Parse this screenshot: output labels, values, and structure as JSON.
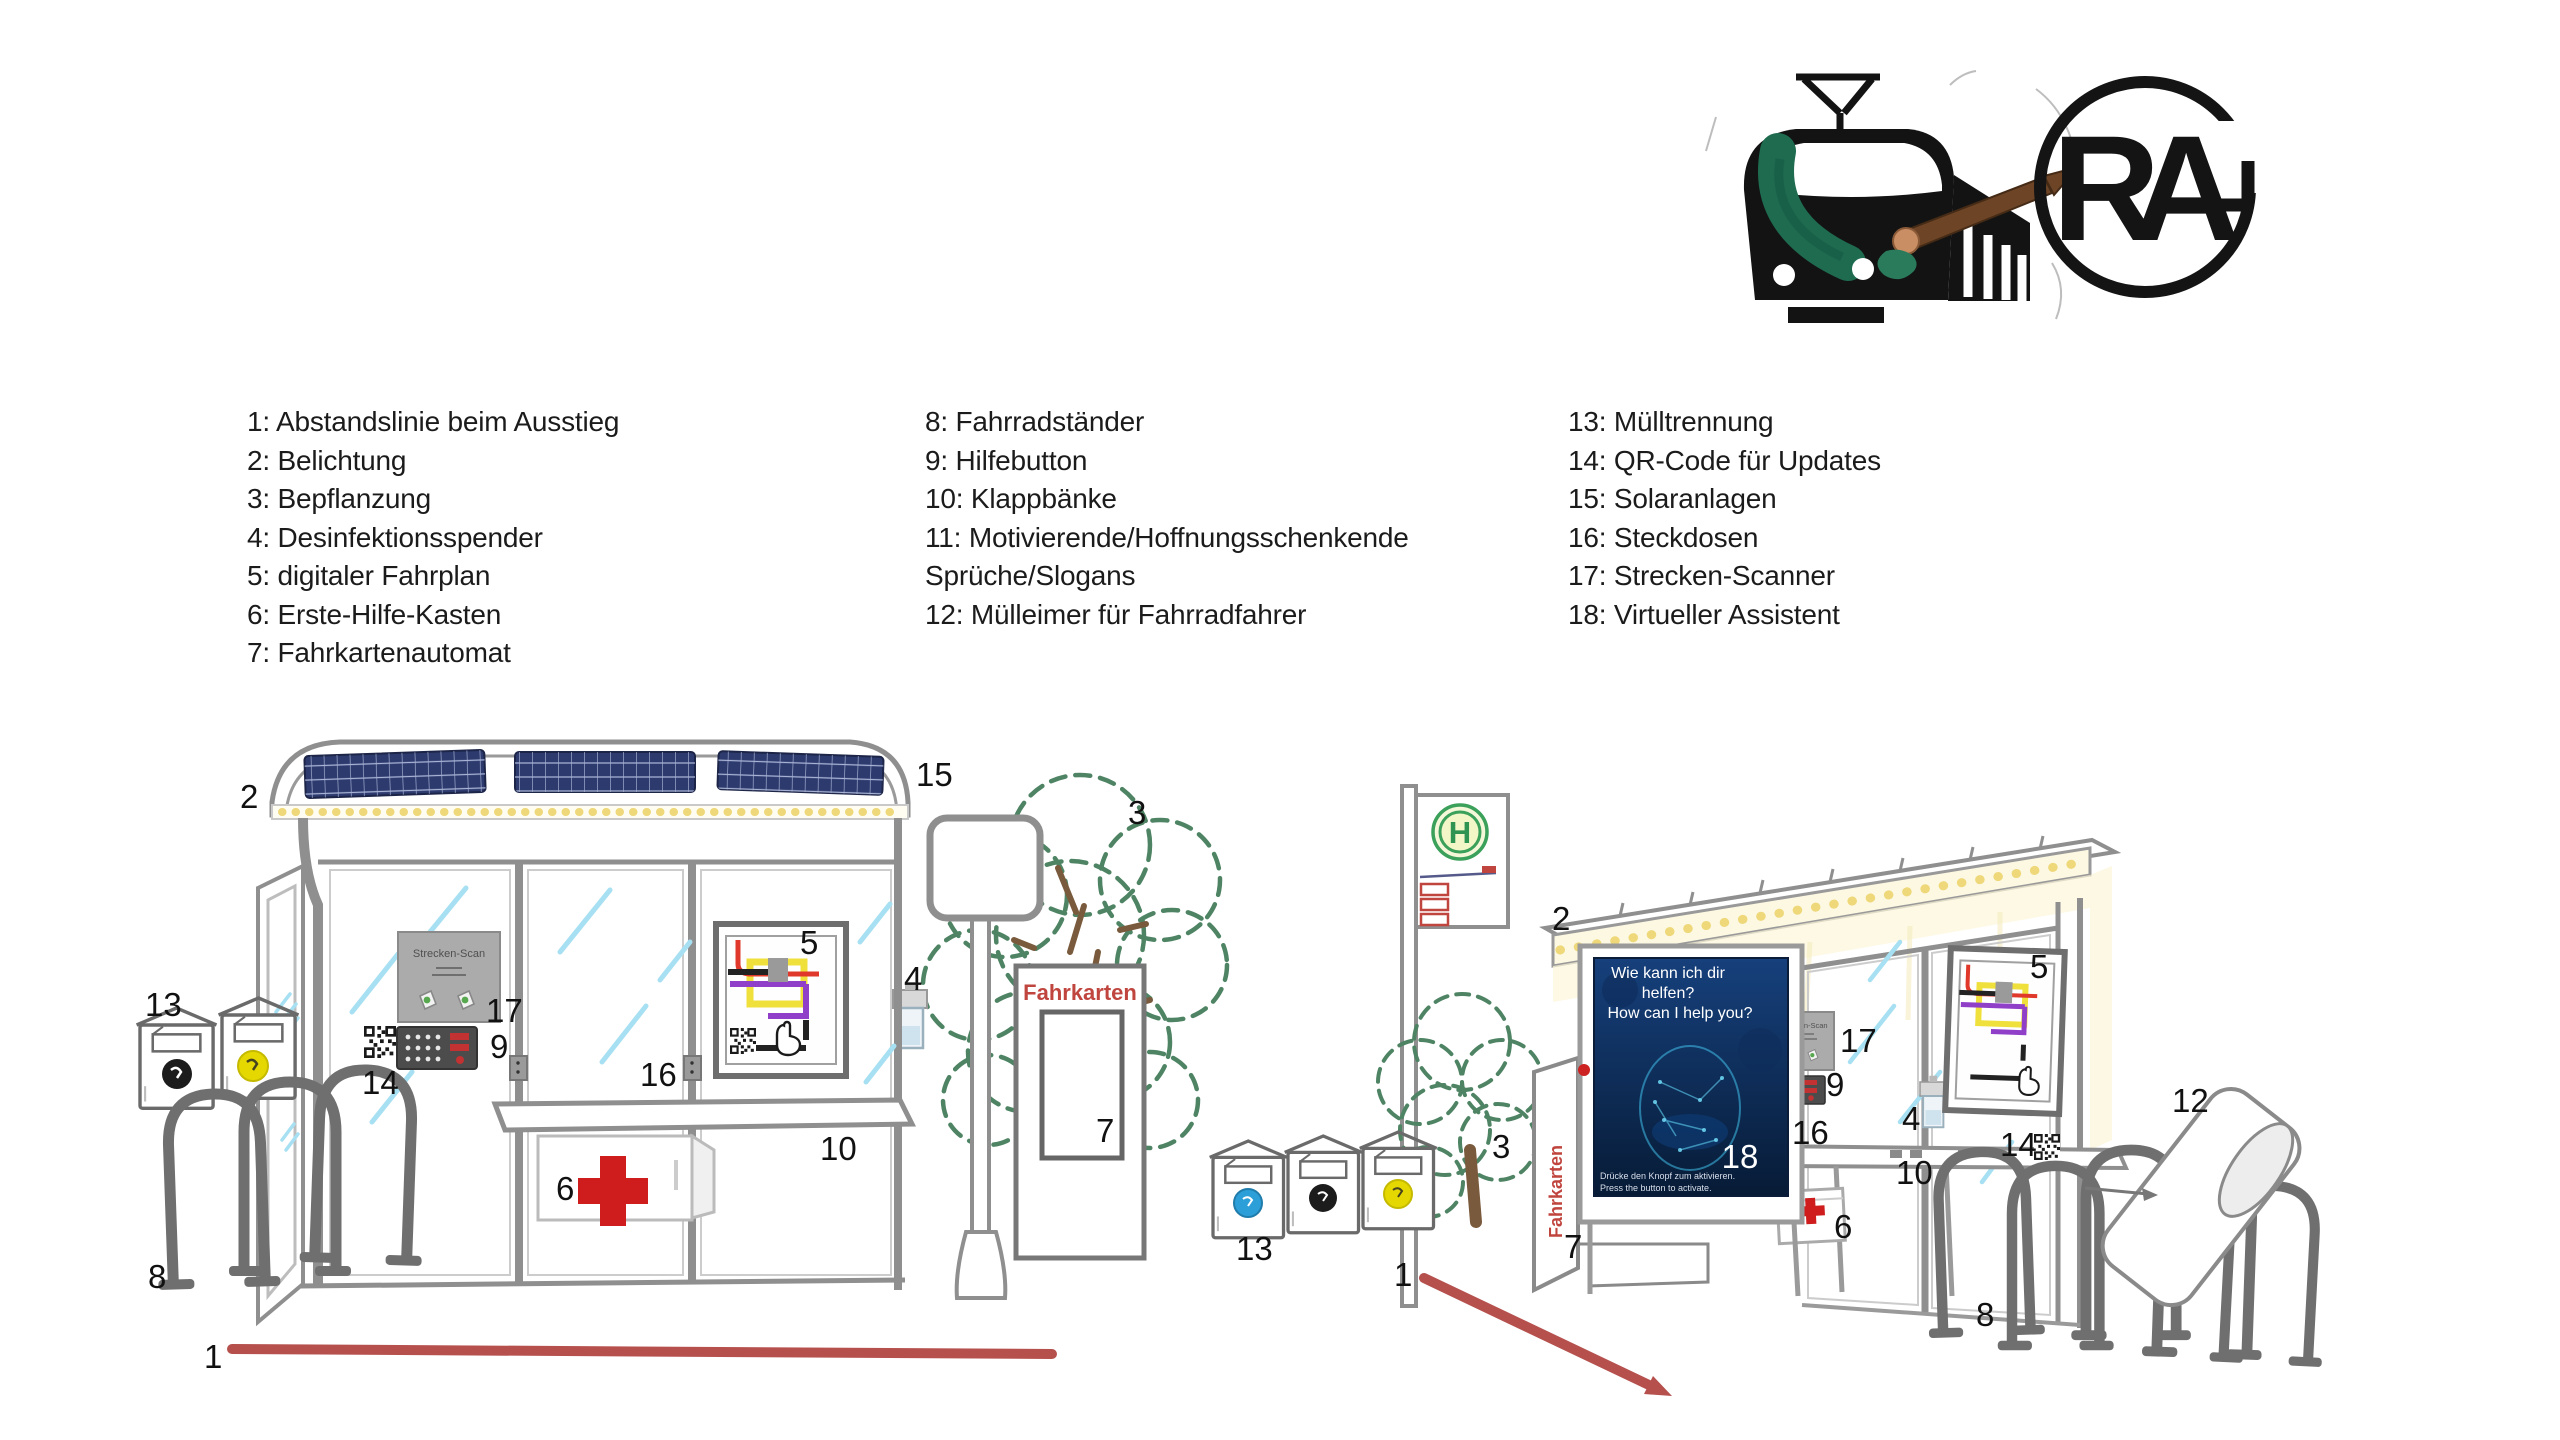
{
  "legend": {
    "col1": [
      "1: Abstandslinie beim Ausstieg",
      "2: Belichtung",
      "3: Bepflanzung",
      "4: Desinfektionsspender",
      "5: digitaler Fahrplan",
      "6: Erste-Hilfe-Kasten",
      "7: Fahrkartenautomat"
    ],
    "col2": [
      "8: Fahrradständer",
      "9: Hilfebutton",
      "10: Klappbänke",
      "11: Motivierende/Hoffnungsschenkende",
      "Sprüche/Slogans",
      "12: Mülleimer für Fahrradfahrer"
    ],
    "col3": [
      "13: Mülltrennung",
      "14: QR-Code für Updates",
      "15: Solaranlagen",
      "16: Steckdosen",
      "17: Strecken-Scanner",
      "18: Virtueller Assistent"
    ]
  },
  "logos": {
    "train_logo": "train-with-paintbrush-logo",
    "monogram": {
      "letter_r": "R",
      "letter_a": "A"
    }
  },
  "scene_left": {
    "scanner_panel_label": "Strecken-Scan",
    "ticket_machine_label": "Fahrkarten",
    "callouts": {
      "exit_line": "1",
      "lighting": "2",
      "planting": "3",
      "dispenser": "4",
      "timetable": "5",
      "first_aid": "6",
      "ticket_machine": "7",
      "bike_racks": "8",
      "help_button": "9",
      "bench": "10",
      "waste": "13",
      "qr": "14",
      "solar": "15",
      "sockets": "16",
      "scanner": "17"
    }
  },
  "scene_right": {
    "scanner_panel_label": "Strecken-Scan",
    "ticket_machine_label": "Fahrkarten",
    "stop_sign_letter": "H",
    "assistant_screen": {
      "line1": "Wie kann ich dir",
      "line2": "helfen?",
      "line3": "How can I help you?",
      "footer_de": "Drücke den Knopf zum aktivieren.",
      "footer_en": "Press the button to activate."
    },
    "callouts": {
      "exit_arrow": "1",
      "lighting": "2",
      "planting": "3",
      "dispenser": "4",
      "timetable": "5",
      "first_aid": "6",
      "ticket_machine": "7",
      "bike_racks": "8",
      "help_button": "9",
      "bench": "10",
      "bike_bin": "12",
      "waste": "13",
      "qr": "14",
      "sockets": "16",
      "scanner": "17",
      "assistant": "18"
    }
  },
  "colors": {
    "accent_red_line": "#b5504d",
    "label_red": "#c0453f",
    "solar_blue": "#2d3a6d",
    "light_yellow": "#eed87a",
    "tree_green": "#4e8464",
    "screen_navy": "#0d2c5a",
    "h_sign_green": "#3aa05a",
    "cross_red": "#cf1d1d",
    "glass_blue": "#a7e0f2"
  }
}
